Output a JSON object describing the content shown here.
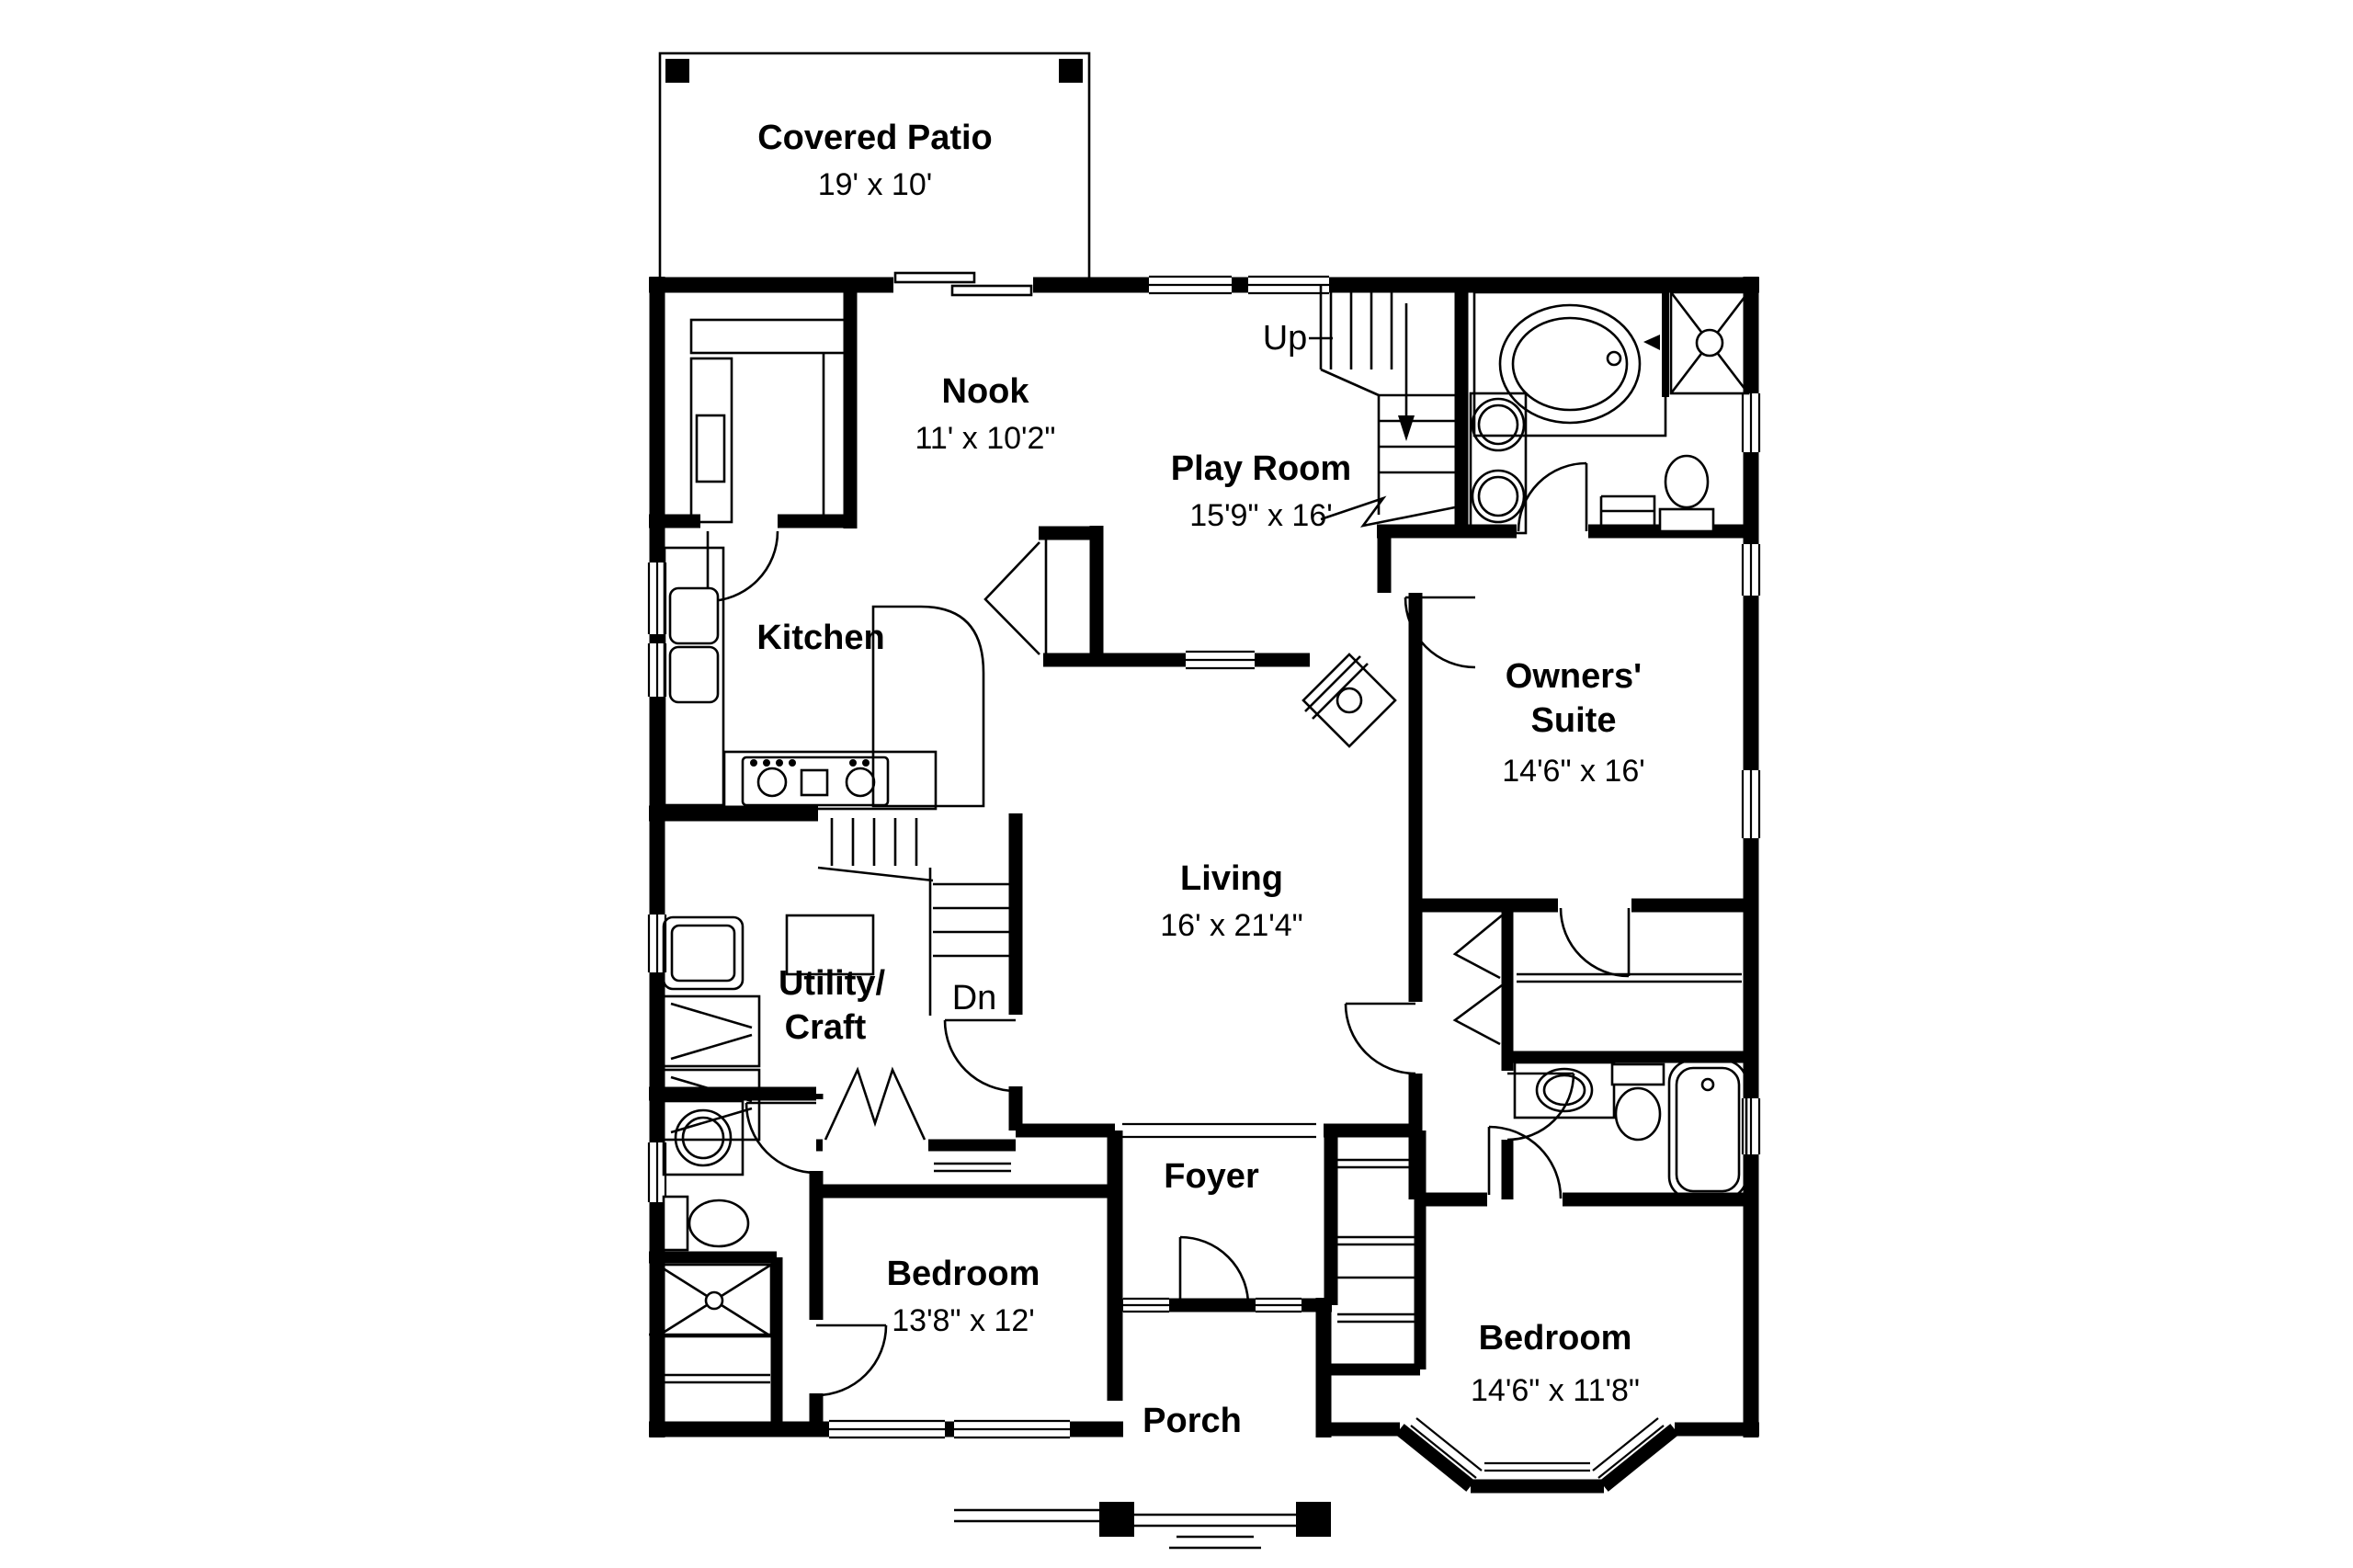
{
  "page": {
    "background": "#ffffff",
    "ink": "#000000",
    "drawing_type": "first-floor house plan"
  },
  "plan": {
    "rooms": [
      {
        "id": "covered_patio",
        "name": "Covered Patio",
        "dims": "19' x 10'"
      },
      {
        "id": "nook",
        "name": "Nook",
        "dims": "11' x 10'2\""
      },
      {
        "id": "play_room",
        "name": "Play Room",
        "dims": "15'9\" x 16'"
      },
      {
        "id": "kitchen",
        "name": "Kitchen"
      },
      {
        "id": "owners_suite",
        "line1": "Owners'",
        "line2": "Suite",
        "dims": "14'6\" x 16'"
      },
      {
        "id": "living",
        "name": "Living",
        "dims": "16' x 21'4\""
      },
      {
        "id": "utility_craft",
        "line1": "Utility/",
        "line2": "Craft"
      },
      {
        "id": "foyer",
        "name": "Foyer"
      },
      {
        "id": "bedroom_front",
        "name": "Bedroom",
        "dims": "13'8\" x 12'"
      },
      {
        "id": "porch",
        "name": "Porch"
      },
      {
        "id": "bedroom_right",
        "name": "Bedroom",
        "dims": "14'6\" x 11'8\""
      }
    ],
    "stairs": {
      "up": "Up",
      "down": "Dn"
    },
    "fixture_icons": [
      "bathtub-icon",
      "shower-icon",
      "toilet-icon",
      "round-sink-icon",
      "double-kitchen-sink-icon",
      "range-icon",
      "washer-icon",
      "dryer-icon",
      "utility-sink-icon",
      "corner-fireplace-icon",
      "stair-treads-icon",
      "bifold-door-icon",
      "swing-door-icon",
      "window-icon",
      "sliding-door-icon",
      "porch-post-icon",
      "patio-post-icon",
      "closet-shelf-icon",
      "bay-window-icon"
    ]
  }
}
